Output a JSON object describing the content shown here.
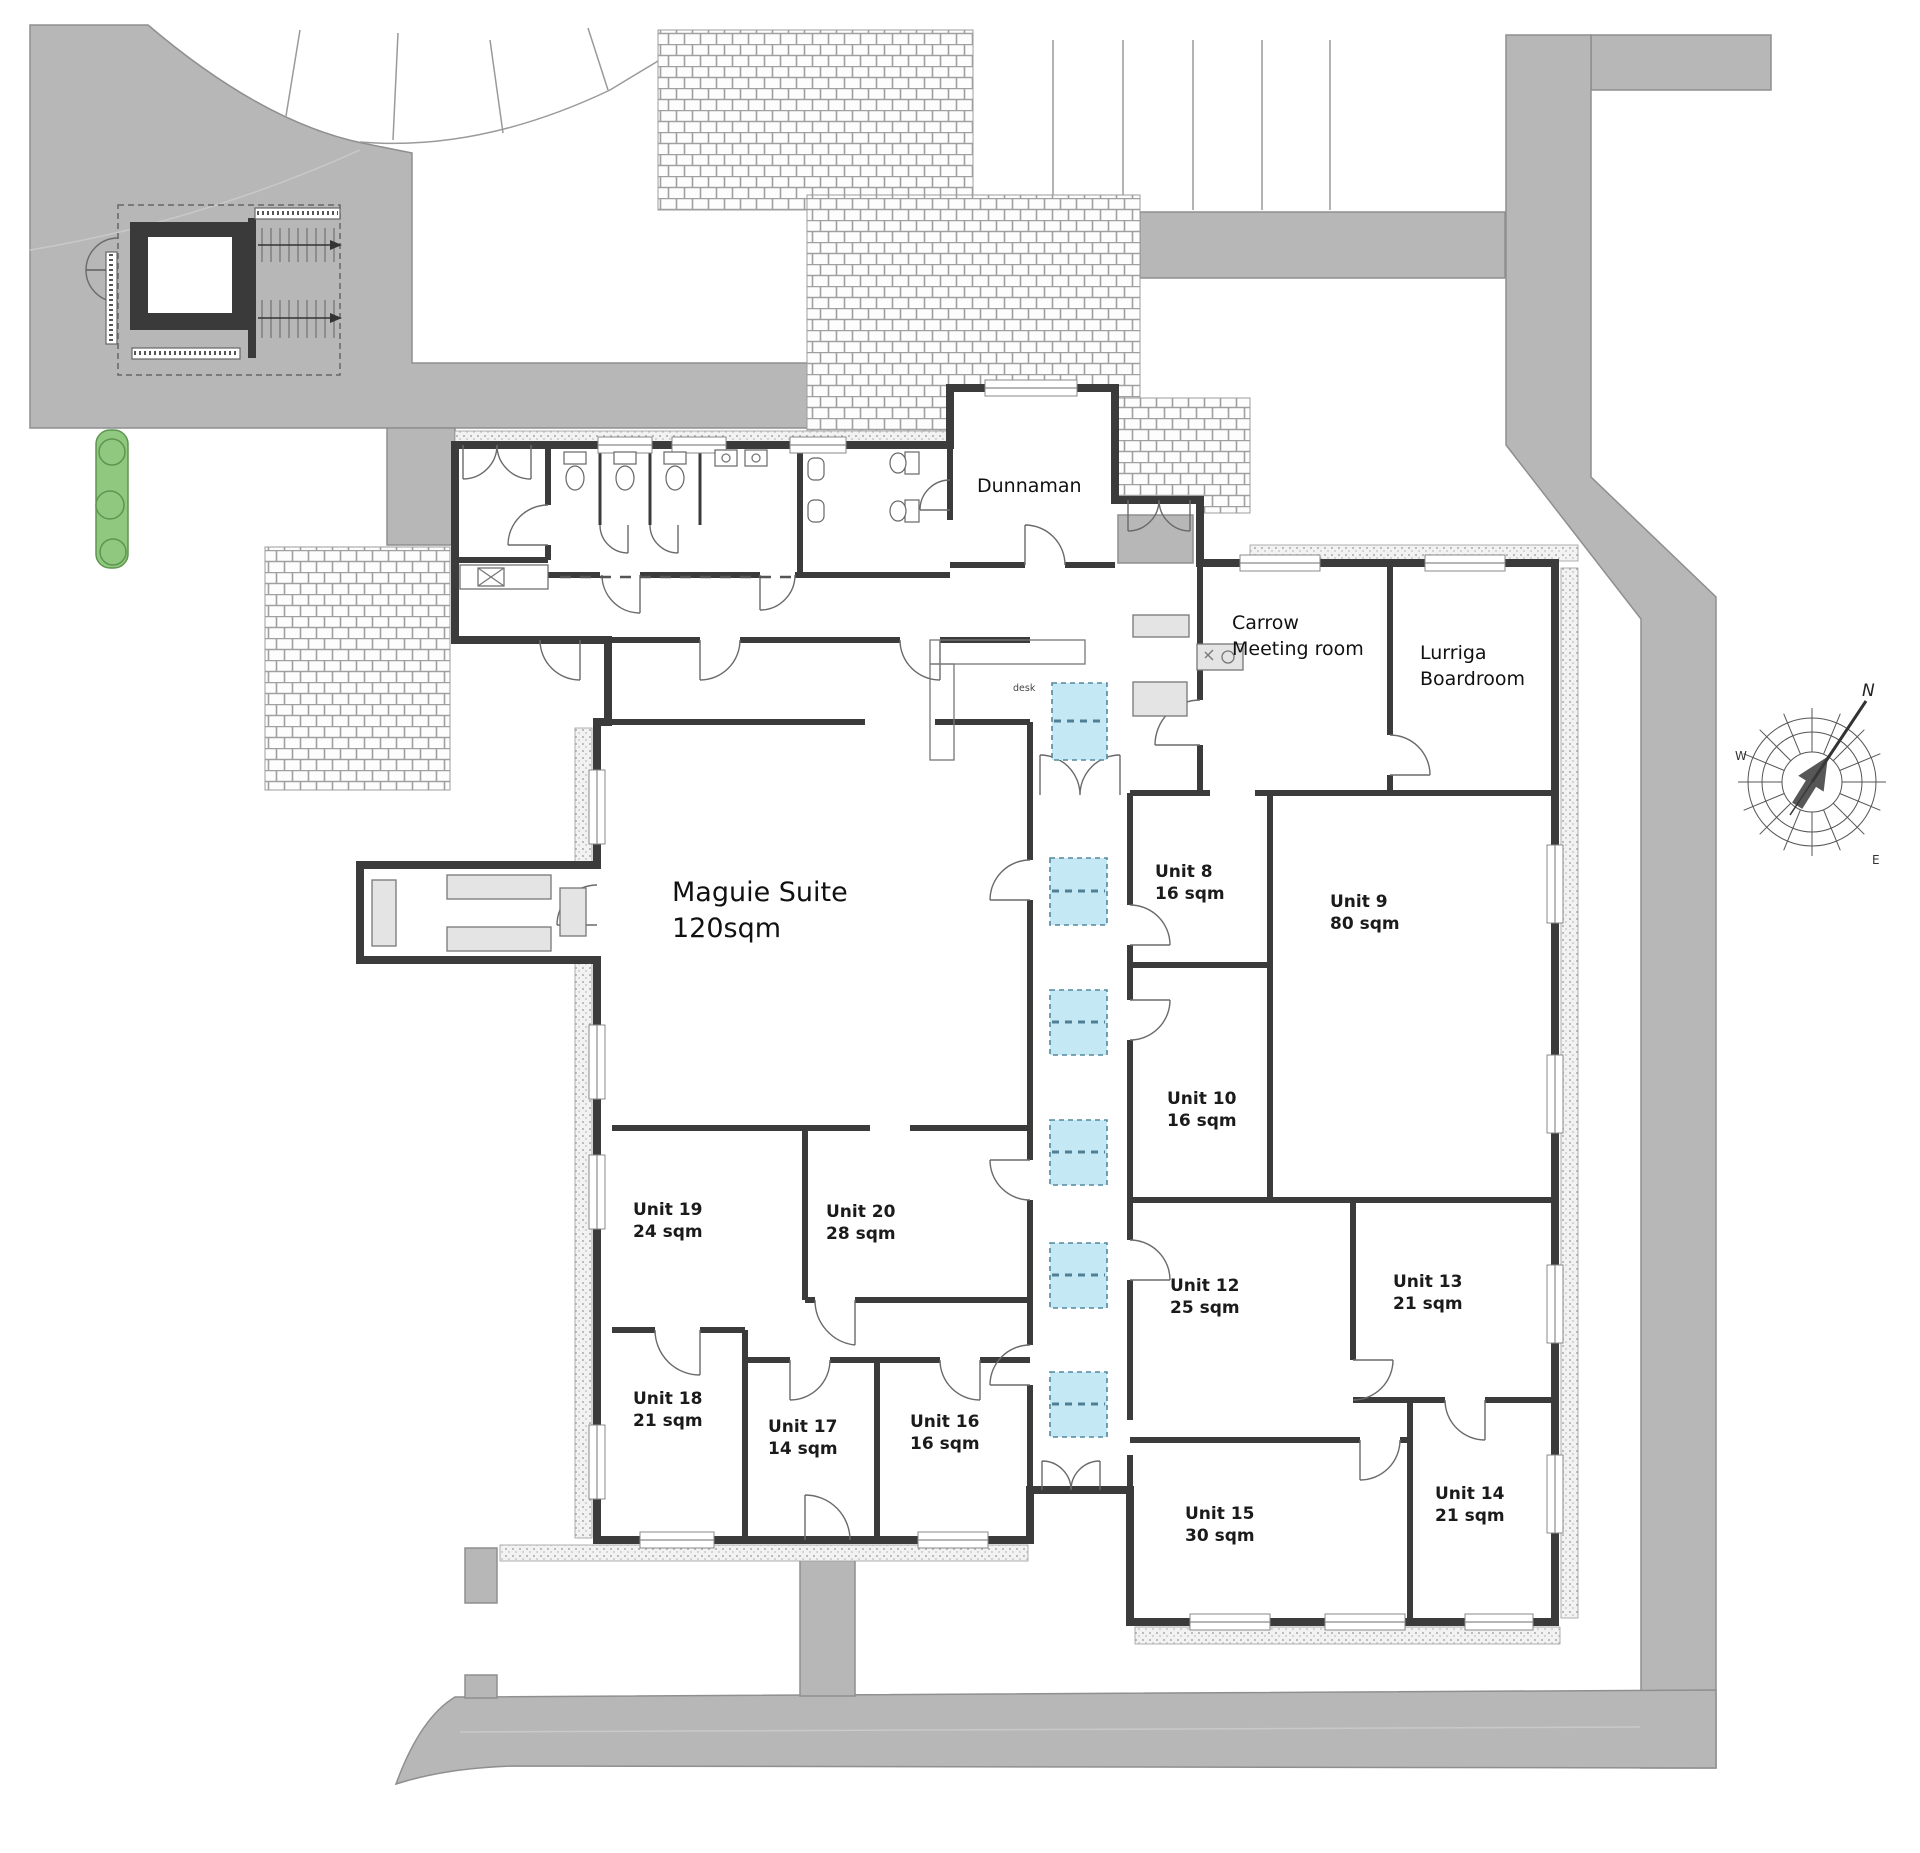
{
  "plan": {
    "rooms": {
      "dunnaman": {
        "label": "Dunnaman"
      },
      "carrow": {
        "line1": "Carrow",
        "line2": "Meeting room"
      },
      "lurriga": {
        "line1": "Lurriga",
        "line2": "Boardroom"
      },
      "maguie": {
        "line1": "Maguie Suite",
        "line2": "120sqm"
      },
      "reception_desk": "desk"
    },
    "units": [
      {
        "id": "unit-8",
        "name": "Unit 8",
        "area": "16 sqm"
      },
      {
        "id": "unit-9",
        "name": "Unit 9",
        "area": "80 sqm"
      },
      {
        "id": "unit-10",
        "name": "Unit 10",
        "area": "16 sqm"
      },
      {
        "id": "unit-12",
        "name": "Unit 12",
        "area": "25 sqm"
      },
      {
        "id": "unit-13",
        "name": "Unit 13",
        "area": "21 sqm"
      },
      {
        "id": "unit-14",
        "name": "Unit 14",
        "area": "21 sqm"
      },
      {
        "id": "unit-15",
        "name": "Unit 15",
        "area": "30 sqm"
      },
      {
        "id": "unit-16",
        "name": "Unit 16",
        "area": "16 sqm"
      },
      {
        "id": "unit-17",
        "name": "Unit 17",
        "area": "14 sqm"
      },
      {
        "id": "unit-18",
        "name": "Unit 18",
        "area": "21 sqm"
      },
      {
        "id": "unit-19",
        "name": "Unit 19",
        "area": "24 sqm"
      },
      {
        "id": "unit-20",
        "name": "Unit 20",
        "area": "28 sqm"
      }
    ],
    "compass": {
      "north": "N",
      "west": "W",
      "east": "E"
    },
    "colors": {
      "road": "#b7b7b7",
      "skylight": "#c5e9f4",
      "hedge": "#8fc87e",
      "wall": "#3b3b3b",
      "brick_line": "#a0a0a0"
    }
  }
}
